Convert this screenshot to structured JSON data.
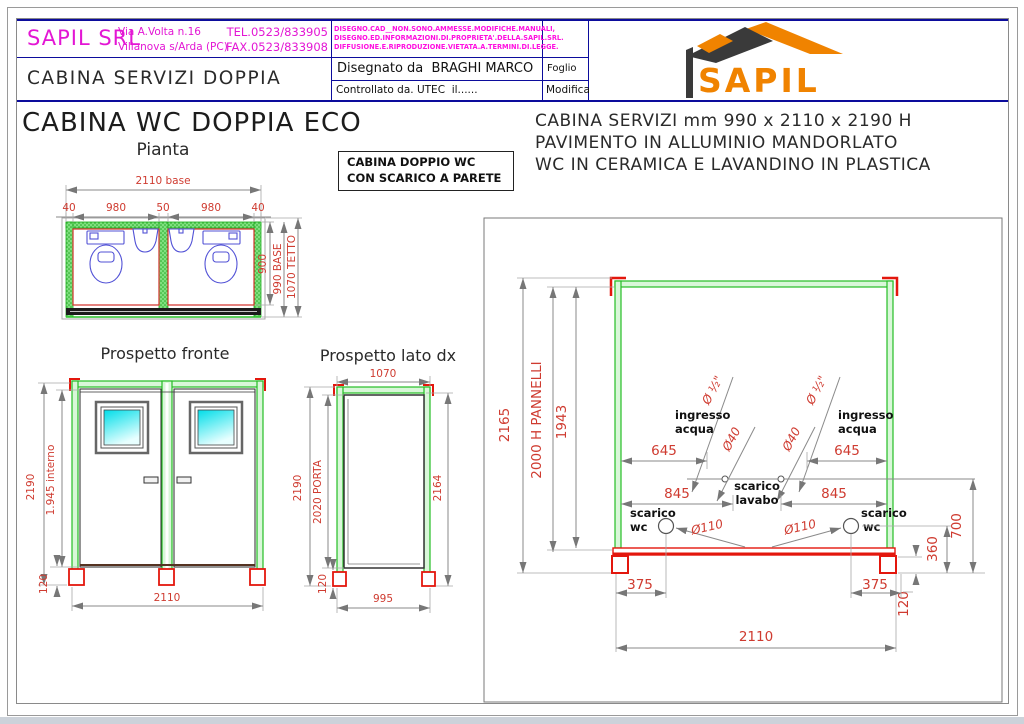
{
  "title_block": {
    "company": "SAPIL SRL",
    "address1": "Via A.Volta n.16",
    "address2": "Villanova s/Arda (PC)",
    "tel": "TEL.0523/833905",
    "fax": "FAX.0523/833908",
    "notice1": "DISEGNO.CAD__NON.SONO.AMMESSE.MODIFICHE.MANUALI,",
    "notice2": "DISEGNO.ED.INFORMAZIONI.DI.PROPRIETA'.DELLA.SAPIL.SRL.",
    "notice3": "DIFFUSIONE.E.RIPRODUZIONE.VIETATA.A.TERMINI.DI.LEGGE.",
    "doc_title": "CABINA SERVIZI DOPPIA",
    "drawn": "Disegnato da  BRAGHI MARCO",
    "checked": "Controllato da. UTEC  il......",
    "sheet": "Foglio",
    "revision": "Modifica",
    "logo": "SAPIL"
  },
  "headings": {
    "main_title": "CABINA WC DOPPIA ECO",
    "plan": "Pianta",
    "front": "Prospetto fronte",
    "side": "Prospetto lato dx",
    "note1": "CABINA DOPPIO WC",
    "note2": "CON SCARICO A PARETE",
    "spec1": "CABINA SERVIZI mm 990 x 2110 x 2190 H",
    "spec2": "PAVIMENTO IN ALLUMINIO MANDORLATO",
    "spec3": "WC IN CERAMICA E LAVANDINO IN PLASTICA"
  },
  "plan": {
    "base": "2110 base",
    "w40l": "40",
    "w980l": "980",
    "w50": "50",
    "w980r": "980",
    "w40r": "40",
    "h900": "900",
    "h990": "990 BASE",
    "h1070": "1070 TETTO"
  },
  "front": {
    "h2190": "2190",
    "interno": "1.945 interno",
    "plinth": "120",
    "w2110": "2110"
  },
  "side": {
    "top1070": "1070",
    "h2190": "2190",
    "door": "2020 PORTA",
    "plinth": "120",
    "h2164": "2164",
    "w995": "995"
  },
  "detail": {
    "h2165": "2165",
    "panels": "2000 H PANNELLI",
    "h1943": "1943",
    "d645l": "645",
    "d645r": "645",
    "d845l": "845",
    "d845r": "845",
    "half_l": "Ø ½\"",
    "half_r": "Ø ½\"",
    "d40l": "Ø40",
    "d40r": "Ø40",
    "ingresso_l1": "ingresso",
    "ingresso_l2": "acqua",
    "ingresso_r1": "ingresso",
    "ingresso_r2": "acqua",
    "scarico1": "scarico",
    "scarico2": "lavabo",
    "wc_l1": "scarico",
    "wc_l2": "wc",
    "wc_r1": "scarico",
    "wc_r2": "wc",
    "d110l": "Ø110",
    "d110r": "Ø110",
    "v700": "700",
    "v360": "360",
    "v120": "120",
    "b375l": "375",
    "b375r": "375",
    "b2110": "2110"
  },
  "colors": {
    "accent_orange": "#f08300",
    "magenta": "#e316d4",
    "dim_red": "#cf3b30",
    "frame_green": "#28c028",
    "frame_red": "#e3170d",
    "fixture_blue": "#5252d6",
    "table_navy": "#0c0c9c"
  }
}
